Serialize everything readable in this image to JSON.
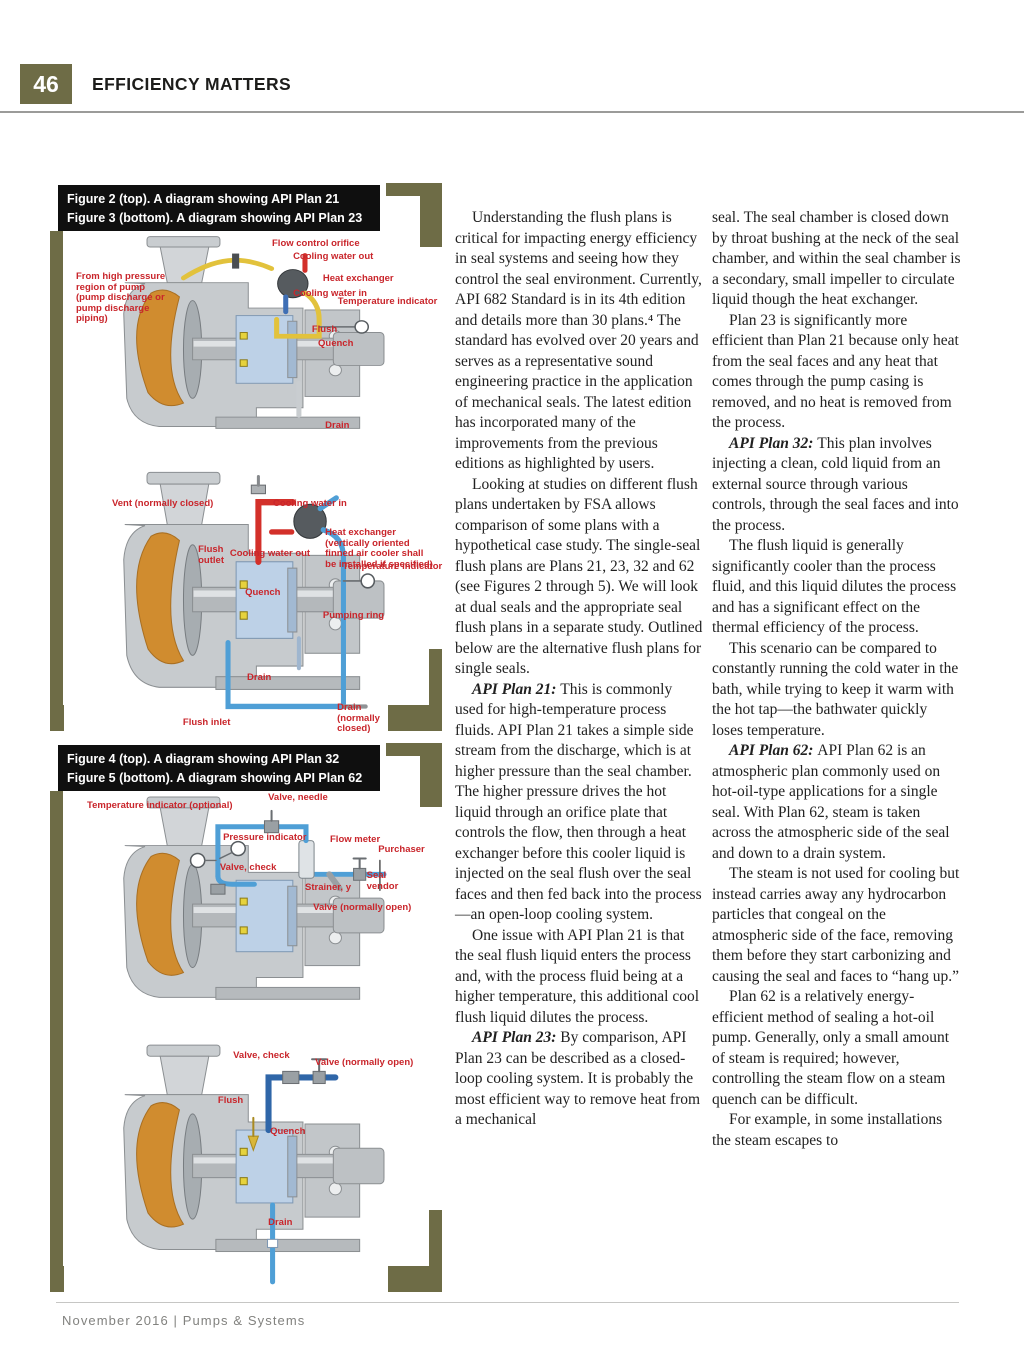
{
  "page": {
    "number": "46",
    "section_title": "EFFICIENCY MATTERS",
    "footer": "November 2016 | Pumps & Systems"
  },
  "colors": {
    "olive_frame": "#6e6c46",
    "caption_bg": "#0f0f0f",
    "label_red": "#c9252b",
    "pipe_yellow": "#e2c23c",
    "pipe_red": "#d3302a",
    "pipe_blue": "#4f9fd6",
    "casing_orange": "#d08c2f",
    "seal_chamber_blue": "#bcd0e6"
  },
  "figures": [
    {
      "caption_lines": [
        "Figure 2 (top). A diagram showing API Plan 21",
        "Figure 3 (bottom). A diagram showing API Plan 23"
      ],
      "diagrams": [
        {
          "plan": "API Plan 21",
          "plan_key": "p21",
          "labels": [
            {
              "text": "Flow control orifice",
              "x": 64.2,
              "y": 3.4
            },
            {
              "text": "Cooling water out",
              "x": 70.7,
              "y": 8.9
            },
            {
              "text": "From high pressure region of pump (pump discharge or pump discharge piping)",
              "x": 3.7,
              "y": 17.4,
              "w": 30
            },
            {
              "text": "Heat exchanger",
              "x": 79.9,
              "y": 18.3
            },
            {
              "text": "Cooling water in",
              "x": 70.7,
              "y": 24.7
            },
            {
              "text": "Temperature indicator",
              "x": 84.5,
              "y": 28.1
            },
            {
              "text": "Flush",
              "x": 76.5,
              "y": 40.0
            },
            {
              "text": "Quench",
              "x": 78.4,
              "y": 46.0
            },
            {
              "text": "Drain",
              "x": 80.6,
              "y": 80.9
            }
          ]
        },
        {
          "plan": "API Plan 23",
          "plan_key": "p23",
          "labels": [
            {
              "text": "Vent (normally closed)",
              "x": 14.8,
              "y": 12.4
            },
            {
              "text": "Cooling water in",
              "x": 64.5,
              "y": 12.4
            },
            {
              "text": "Heat exchanger (vertically oriented finned air cooler shall be installed if specified)",
              "x": 80.6,
              "y": 23.3,
              "w": 34
            },
            {
              "text": "Flush outlet",
              "x": 41.4,
              "y": 29.7,
              "w": 10
            },
            {
              "text": "Cooling water out",
              "x": 51.2,
              "y": 31.2
            },
            {
              "text": "Temperature indicator",
              "x": 86.0,
              "y": 36.1
            },
            {
              "text": "Quench",
              "x": 55.9,
              "y": 45.9
            },
            {
              "text": "Pumping ring",
              "x": 79.9,
              "y": 54.5
            },
            {
              "text": "Drain",
              "x": 56.5,
              "y": 77.8
            },
            {
              "text": "Flush inlet",
              "x": 36.7,
              "y": 94.7
            },
            {
              "text": "Drain (normally closed)",
              "x": 84.3,
              "y": 89.1,
              "w": 15
            }
          ]
        }
      ]
    },
    {
      "caption_lines": [
        "Figure 4 (top). A diagram showing API Plan 32",
        "Figure 5 (bottom). A diagram showing API Plan 62"
      ],
      "diagrams": [
        {
          "plan": "API Plan 32",
          "plan_key": "p32",
          "labels": [
            {
              "text": "Valve, needle",
              "x": 63.0,
              "y": 1.0
            },
            {
              "text": "Temperature indicator (optional)",
              "x": 7.1,
              "y": 4.0
            },
            {
              "text": "Pressure indicator",
              "x": 49.1,
              "y": 16.9
            },
            {
              "text": "Flow meter",
              "x": 82.1,
              "y": 17.7
            },
            {
              "text": "Purchaser",
              "x": 97.0,
              "y": 21.8
            },
            {
              "text": "Valve, check",
              "x": 48.1,
              "y": 29.0
            },
            {
              "text": "Strainer, y",
              "x": 74.4,
              "y": 37.1
            },
            {
              "text": "Seal vendor",
              "x": 93.4,
              "y": 32.3,
              "w": 10
            },
            {
              "text": "Valve (normally open)",
              "x": 76.9,
              "y": 45.2
            }
          ]
        },
        {
          "plan": "API Plan 62",
          "plan_key": "p62",
          "labels": [
            {
              "text": "Valve, check",
              "x": 52.2,
              "y": 4.7
            },
            {
              "text": "Valve (normally open)",
              "x": 77.5,
              "y": 7.5
            },
            {
              "text": "Flush",
              "x": 47.5,
              "y": 22.5
            },
            {
              "text": "Quench",
              "x": 63.6,
              "y": 34.8
            },
            {
              "text": "Drain",
              "x": 63.0,
              "y": 70.8
            }
          ]
        }
      ]
    }
  ],
  "article": {
    "columns": [
      {
        "paragraphs": [
          {
            "lead": "",
            "text": "Understanding the flush plans is critical for impacting energy efficiency in seal systems and seeing how they control the seal environment. Currently, API 682 Standard is in its 4th edition and details more than 30 plans.⁴ The standard has evolved over 20 years and serves as a representative sound engineering practice in the application of mechanical seals. The latest edition has incorporated many of the improvements from the previous editions as highlighted by users."
          },
          {
            "lead": "",
            "text": "Looking at studies on different flush plans undertaken by FSA allows comparison of some plans with a hypothetical case study. The single-seal flush plans are Plans 21, 23, 32 and 62 (see Figures 2 through 5). We will look at dual seals and the appropriate seal flush plans in a separate study. Outlined below are the alternative flush plans for single seals."
          },
          {
            "lead": "API Plan 21:",
            "text": "This is commonly used for high-temperature process fluids. API Plan 21 takes a simple side stream from the discharge, which is at higher pressure than the seal chamber. The higher pressure drives the hot liquid through an orifice plate that controls the flow, then through a heat exchanger before this cooler liquid is injected on the seal flush over the seal faces and then fed back into the process—an open-loop cooling system."
          },
          {
            "lead": "",
            "text": "One issue with API Plan 21 is that the seal flush liquid enters the process and, with the process fluid being at a higher temperature, this additional cool flush liquid dilutes the process."
          },
          {
            "lead": "API Plan 23:",
            "text": "By comparison, API Plan 23 can be described as a closed-loop cooling system. It is probably the most efficient way to remove heat from a mechanical"
          }
        ]
      },
      {
        "paragraphs": [
          {
            "lead": "",
            "indent": false,
            "text": "seal. The seal chamber is closed down by throat bushing at the neck of the seal chamber, and within the seal chamber is a secondary, small impeller to circulate liquid though the heat exchanger."
          },
          {
            "lead": "",
            "text": "Plan 23 is significantly more efficient than Plan 21 because only heat from the seal faces and any heat that comes through the pump casing is removed, and no heat is removed from the process."
          },
          {
            "lead": "API Plan 32:",
            "text": "This plan involves injecting a clean, cold liquid from an external source through various controls, through the seal faces and into the process."
          },
          {
            "lead": "",
            "text": "The flush liquid is generally significantly cooler than the process fluid, and this liquid dilutes the process and has a significant effect on the thermal efficiency of the process."
          },
          {
            "lead": "",
            "text": "This scenario can be compared to constantly running the cold water in the bath, while trying to keep it warm with the hot tap—the bathwater quickly loses temperature."
          },
          {
            "lead": "API Plan 62:",
            "text": "API Plan 62 is an atmospheric plan commonly used on hot-oil-type applications for a single seal. With Plan 62, steam is taken across the atmospheric side of the seal and down to a drain system."
          },
          {
            "lead": "",
            "text": "The steam is not used for cooling but instead carries away any hydrocarbon particles that congeal on the atmospheric side of the face, removing them before they start carbonizing and causing the seal and faces to “hang up.”"
          },
          {
            "lead": "",
            "text": "Plan 62 is a relatively energy-efficient method of sealing a hot-oil pump. Generally, only a small amount of steam is required; however, controlling the steam flow on a steam quench can be difficult."
          },
          {
            "lead": "",
            "text": "For example, in some installations the steam escapes to"
          }
        ]
      }
    ]
  }
}
